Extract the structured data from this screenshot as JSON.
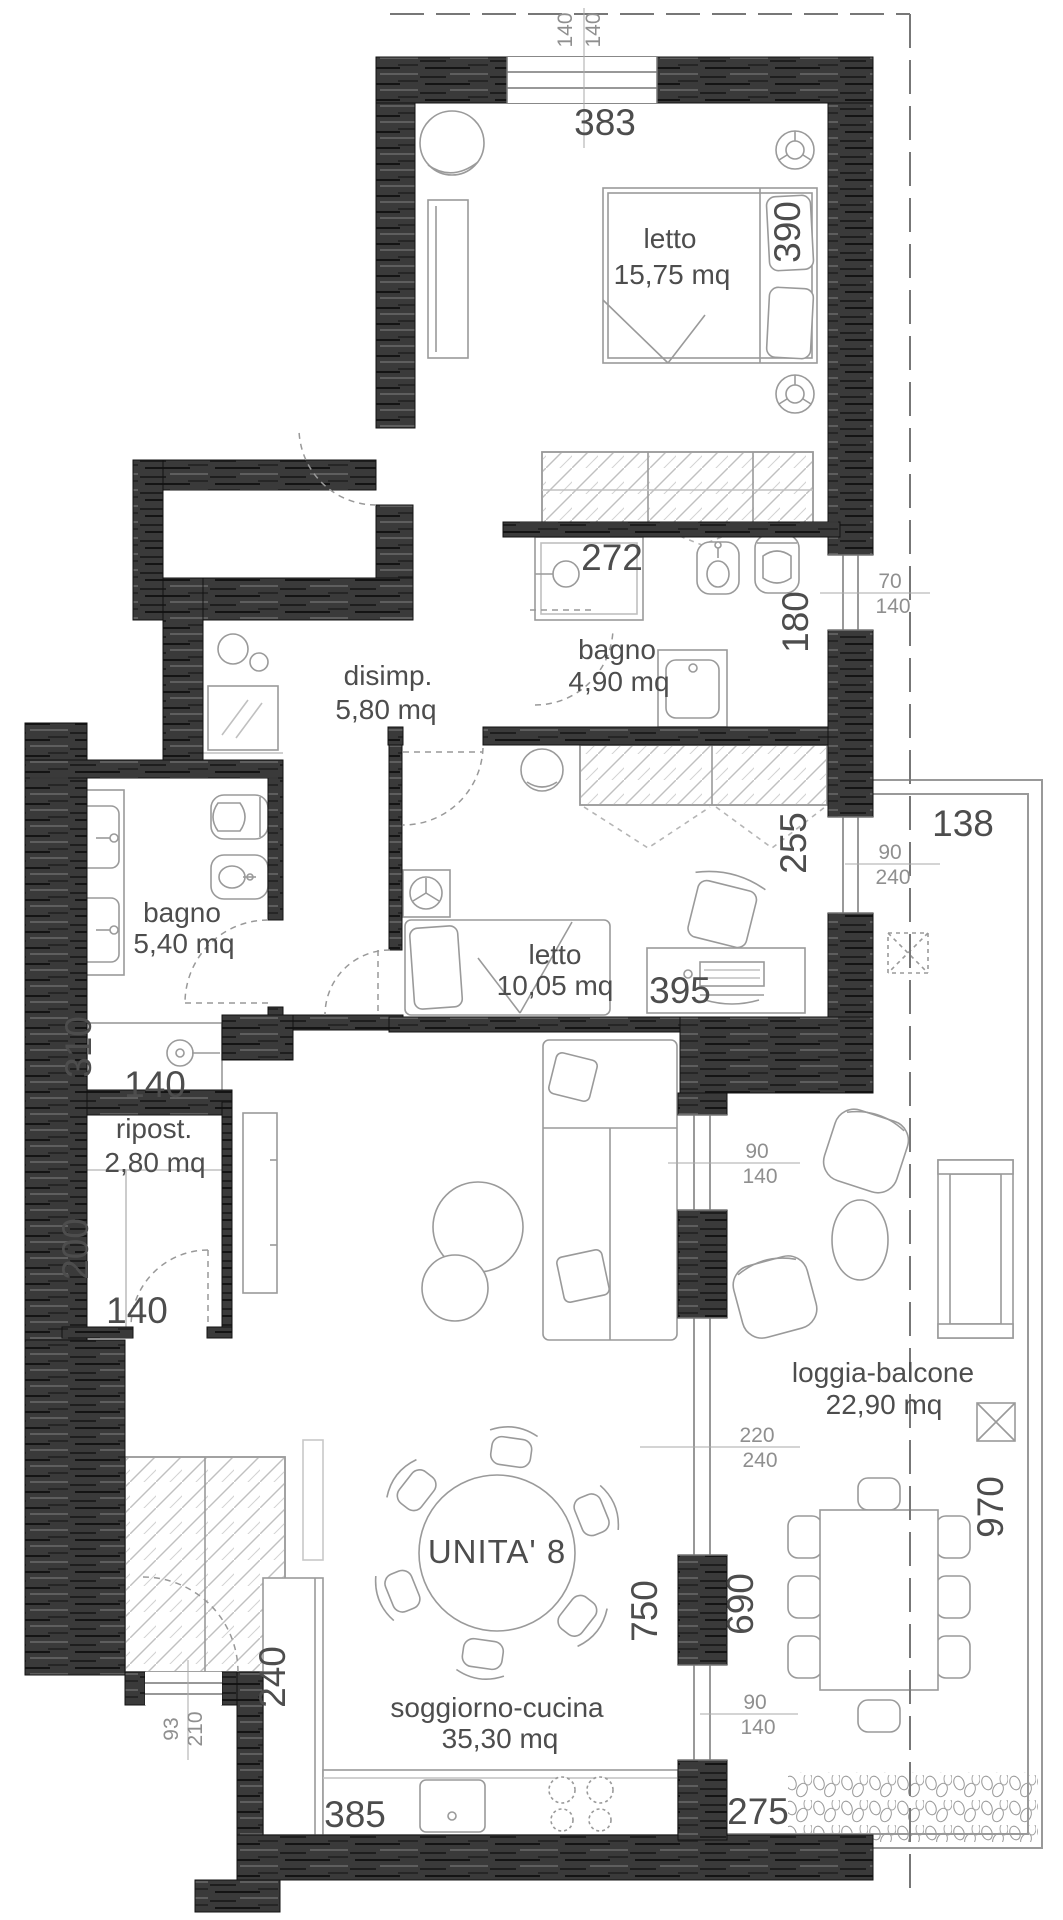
{
  "unit": {
    "label": "UNITA' 8"
  },
  "rooms": {
    "letto1": {
      "name": "letto",
      "area": "15,75 mq"
    },
    "bagno1": {
      "name": "bagno",
      "area": "4,90 mq"
    },
    "disimpegno": {
      "name": "disimp.",
      "area": "5,80 mq"
    },
    "bagno2": {
      "name": "bagno",
      "area": "5,40 mq"
    },
    "letto2": {
      "name": "letto",
      "area": "10,05 mq"
    },
    "ripostiglio": {
      "name": "ripost.",
      "area": "2,80 mq"
    },
    "soggiorno": {
      "name": "soggiorno-cucina",
      "area": "35,30 mq"
    },
    "loggia": {
      "name": "loggia-balcone",
      "area": "22,90 mq"
    }
  },
  "dimensions": {
    "bedroom1_width": "383",
    "bedroom1_height": "390",
    "bathroom1_width": "272",
    "bathroom1_height": "180",
    "bedroom2_width": "395",
    "bedroom2_height": "255",
    "loggia_top_width": "138",
    "bathroom2_height": "310",
    "shower_width": "140",
    "storage_height": "200",
    "storage_width": "140",
    "kitchen_return_depth": "240",
    "kitchen_width": "385",
    "living_height": "750",
    "loggia_inner_height": "690",
    "loggia_right_height": "970",
    "loggia_bottom_width": "275"
  },
  "openings": {
    "top_window": {
      "w": "140",
      "h": "140"
    },
    "bath1_window": {
      "w": "70",
      "h": "140"
    },
    "bed2_window": {
      "w": "90",
      "h": "240"
    },
    "living_window_upper": {
      "w": "90",
      "h": "140"
    },
    "living_glass_door": {
      "w": "220",
      "h": "240"
    },
    "living_window_lower": {
      "w": "90",
      "h": "140"
    },
    "entry_door": {
      "w": "93",
      "h": "210"
    }
  },
  "colors": {
    "wall": "#3a3a3a",
    "furniture_line": "#9a9a9a",
    "dim_text": "#4d4d4d",
    "frac_text": "#8f8f8f"
  }
}
